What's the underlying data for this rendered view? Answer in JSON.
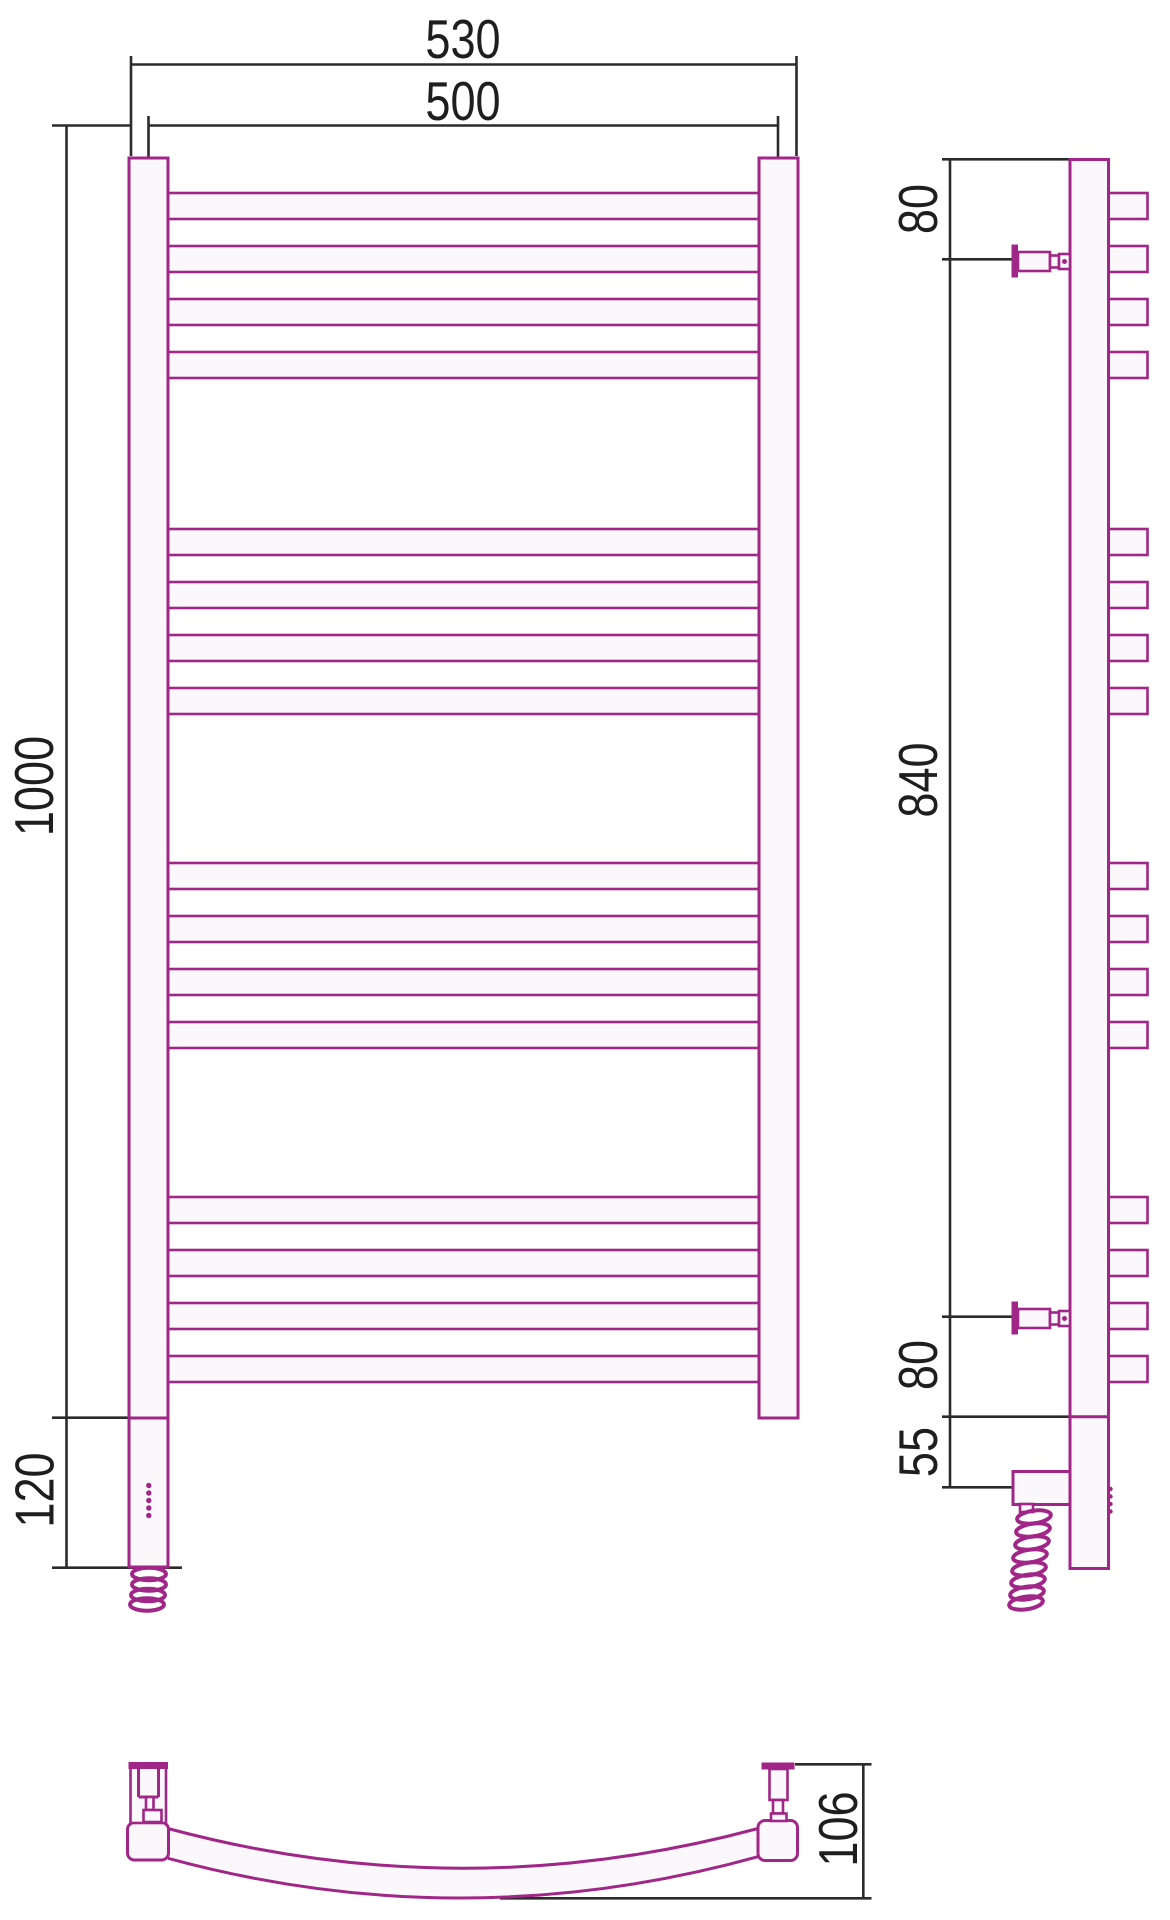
{
  "drawing": {
    "accent_color": "#A02787",
    "line_color": "#2B2B2B",
    "views": {
      "front": {
        "label_width_overall": "530",
        "label_width_centers": "500",
        "label_height": "1000",
        "label_bottom_section": "120"
      },
      "side": {
        "label_top_offset": "80",
        "label_bracket_span": "840",
        "label_bottom_offset": "80",
        "label_element_offset": "55"
      },
      "bottom": {
        "label_depth": "106"
      }
    },
    "rungs": {
      "group_tops": [
        193,
        529,
        863,
        1197
      ],
      "per_group": 4,
      "pitch": 53,
      "tube_height": 26,
      "front_x": 167,
      "front_width": 592.5,
      "side_x": 1108,
      "side_width": 39.5
    }
  }
}
